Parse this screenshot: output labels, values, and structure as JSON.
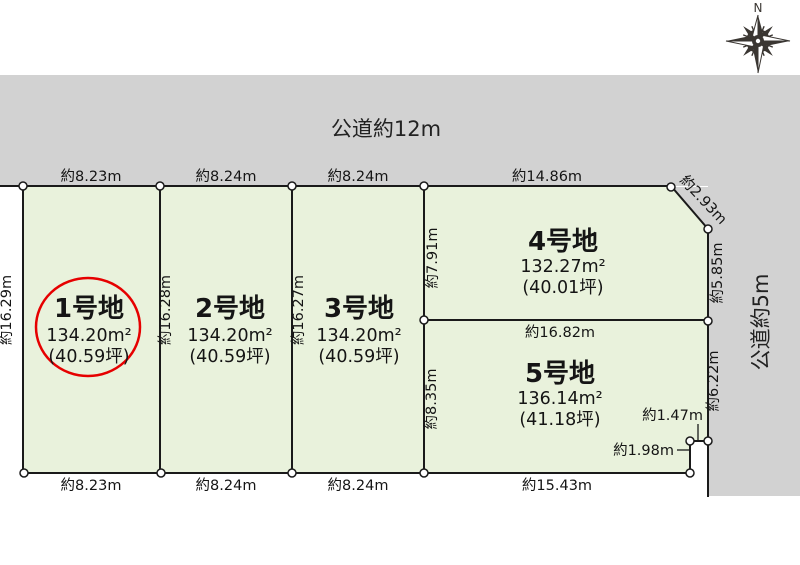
{
  "compass": {
    "north": "N"
  },
  "roads": {
    "top_label": "公道約12m",
    "right_label": "公道約5m"
  },
  "plots": [
    {
      "name": "1号地",
      "area": "134.20m²",
      "tsubo": "(40.59坪)",
      "highlighted": true
    },
    {
      "name": "2号地",
      "area": "134.20m²",
      "tsubo": "(40.59坪)",
      "highlighted": false
    },
    {
      "name": "3号地",
      "area": "134.20m²",
      "tsubo": "(40.59坪)",
      "highlighted": false
    },
    {
      "name": "4号地",
      "area": "132.27m²",
      "tsubo": "(40.01坪)",
      "highlighted": false
    },
    {
      "name": "5号地",
      "area": "136.14m²",
      "tsubo": "(41.18坪)",
      "highlighted": false
    }
  ],
  "dimensions": {
    "top": [
      "約8.23m",
      "約8.24m",
      "約8.24m",
      "約14.86m"
    ],
    "bottom": [
      "約8.23m",
      "約8.24m",
      "約8.24m",
      "約15.43m"
    ],
    "plot1_left": "約16.29m",
    "plot2_left": "約16.28m",
    "plot3_left": "約16.27m",
    "plot4_left": "約7.91m",
    "plot5_left": "約8.35m",
    "chamfer": "約2.93m",
    "plot4_right": "約5.85m",
    "plot5_right": "約6.22m",
    "plot45_boundary": "約16.82m",
    "notch_top": "約1.47m",
    "notch_side": "約1.98m"
  },
  "colors": {
    "plot_fill": "#e9f2dc",
    "road_fill": "#d2d2d2",
    "outline": "#1a1a1a",
    "highlight_circle": "#e60000",
    "compass": "#3a3632"
  }
}
